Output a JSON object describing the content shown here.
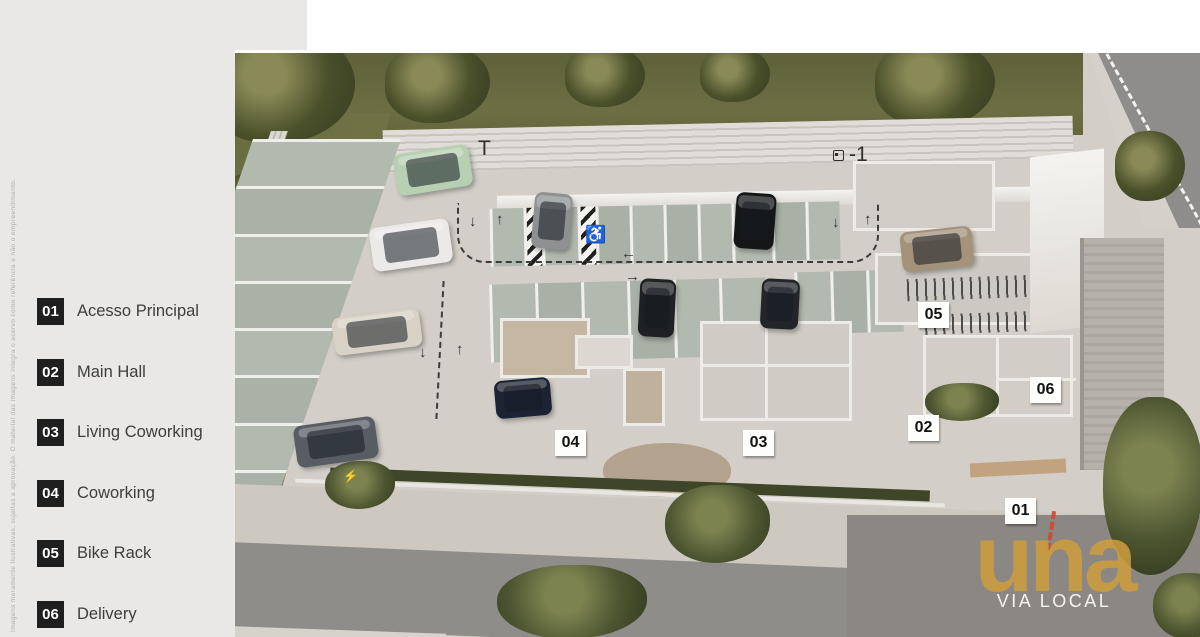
{
  "legend": {
    "items": [
      {
        "number": "01",
        "label": "Acesso Principal"
      },
      {
        "number": "02",
        "label": "Main Hall"
      },
      {
        "number": "03",
        "label": "Living Coworking"
      },
      {
        "number": "04",
        "label": "Coworking"
      },
      {
        "number": "05",
        "label": "Bike Rack"
      },
      {
        "number": "06",
        "label": "Delivery"
      }
    ],
    "disclaimer": "Imagens meramente ilustrativas, sujeitas a aprovação. O material das imagens integra o acervo como referência e não o empreendimento."
  },
  "plan": {
    "floor_label": "T",
    "level_label": "-1",
    "level_icon": "elevator-icon",
    "accessible_symbol": "♿",
    "ev_symbol": "⚡",
    "accessible_pos": {
      "x": 350,
      "y": 172
    },
    "ev_pos": {
      "x": 108,
      "y": 416
    },
    "floor_label_pos": {
      "x": 243,
      "y": 84
    },
    "level_label_pos": {
      "x": 598,
      "y": 90
    },
    "markers": [
      {
        "number": "01",
        "x": 770,
        "y": 445
      },
      {
        "number": "02",
        "x": 673,
        "y": 362
      },
      {
        "number": "03",
        "x": 508,
        "y": 377
      },
      {
        "number": "04",
        "x": 320,
        "y": 377
      },
      {
        "number": "05",
        "x": 683,
        "y": 249
      },
      {
        "number": "06",
        "x": 795,
        "y": 324
      }
    ],
    "arrows": [
      {
        "glyph": "↓",
        "x": 234,
        "y": 160
      },
      {
        "glyph": "↑",
        "x": 261,
        "y": 158
      },
      {
        "glyph": "←",
        "x": 386,
        "y": 192
      },
      {
        "glyph": "→",
        "x": 390,
        "y": 215
      },
      {
        "glyph": "↓",
        "x": 597,
        "y": 161
      },
      {
        "glyph": "↑",
        "x": 629,
        "y": 158
      },
      {
        "glyph": "↓",
        "x": 184,
        "y": 291
      },
      {
        "glyph": "↑",
        "x": 221,
        "y": 288
      }
    ],
    "cars": [
      {
        "color": "#b7d0b2",
        "x": 160,
        "y": 96,
        "w": 76,
        "h": 42,
        "rot": -9
      },
      {
        "color": "#eceae8",
        "x": 136,
        "y": 170,
        "w": 80,
        "h": 44,
        "rot": -8
      },
      {
        "color": "#d8d2c6",
        "x": 98,
        "y": 260,
        "w": 88,
        "h": 38,
        "rot": -7
      },
      {
        "color": "#585d64",
        "x": 60,
        "y": 368,
        "w": 82,
        "h": 42,
        "rot": -8
      },
      {
        "color": "#1c2335",
        "x": 260,
        "y": 326,
        "w": 56,
        "h": 38,
        "rot": -5
      },
      {
        "color": "#8e9092",
        "x": 298,
        "y": 140,
        "w": 38,
        "h": 56,
        "rot": 5
      },
      {
        "color": "#151617",
        "x": 500,
        "y": 140,
        "w": 40,
        "h": 56,
        "rot": 4
      },
      {
        "color": "#1e2023",
        "x": 404,
        "y": 226,
        "w": 36,
        "h": 58,
        "rot": 3
      },
      {
        "color": "#23252a",
        "x": 526,
        "y": 226,
        "w": 38,
        "h": 50,
        "rot": 3
      },
      {
        "color": "#a5927a",
        "x": 666,
        "y": 176,
        "w": 72,
        "h": 40,
        "rot": -6
      }
    ]
  },
  "logo": {
    "brand": "una",
    "tagline": "VIA LOCAL",
    "gold": "#cf9d3c",
    "accent": "#cf4a2d"
  },
  "colors": {
    "sidebar": "#e9e8e6",
    "badge": "#1f1f1f",
    "deck": "#d3cfc8",
    "stall": "#b2b9ae",
    "grass": "#63673c",
    "road": "#8e8d8b"
  }
}
